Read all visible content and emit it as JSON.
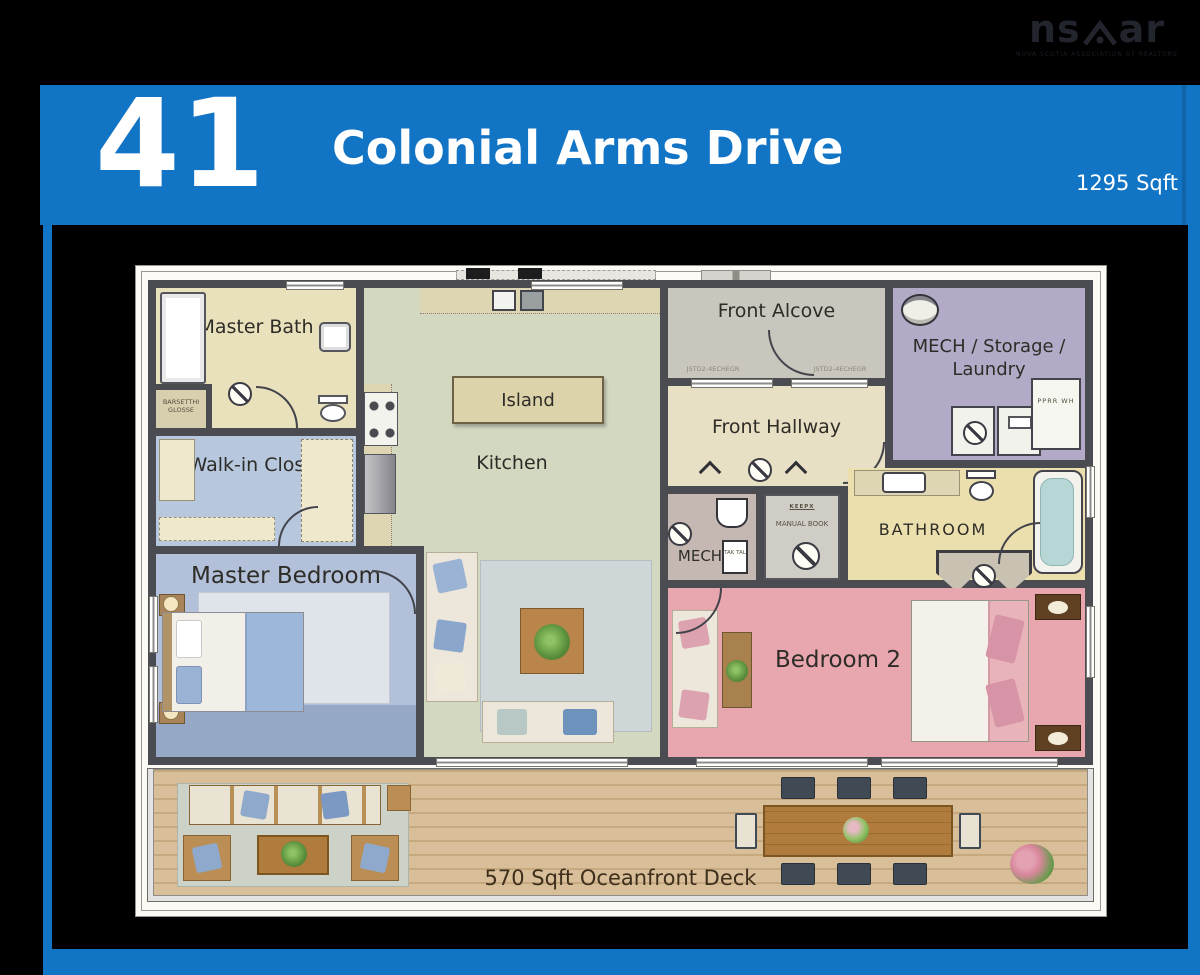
{
  "logo": {
    "left": "ns",
    "right": "ar",
    "subtext": "NOVA SCOTIA ASSOCIATION OF REALTORS"
  },
  "header": {
    "house_number": "41",
    "street": "Colonial Arms Drive",
    "area": "1295 Sqft",
    "accent_color": "#1274c5"
  },
  "rooms": {
    "master_bath": "Master Bath",
    "walk_in_closet": "Walk-in Closet",
    "master_bedroom": "Master Bedroom",
    "island": "Island",
    "kitchen": "Kitchen",
    "front_alcove": "Front Alcove",
    "front_hallway": "Front Hallway",
    "mech_storage_laundry": "MECH / Storage / Laundry",
    "mech": "MECH",
    "bathroom": "BATHROOM",
    "bedroom_2": "Bedroom 2"
  },
  "deck": {
    "label": "570 Sqft Oceanfront Deck"
  },
  "annotations": {
    "closet_tag": "BARSETTHI GLOSSE",
    "alcove_dim_left": "JSTD2-4ECHEGR",
    "alcove_dim_right": "JSTD2-4ECHEGR",
    "keep_tag": "KEEPX",
    "manual_tag": "MANUAL BOOK",
    "tak_tag": "TAK TAL",
    "wh_tag": "PPRR WH"
  },
  "palette": {
    "wall": "#4b4b52",
    "master_bath_floor": "#e9e0bc",
    "closet_floor": "#b7c7de",
    "master_bedroom_floor": "#b2c1d9",
    "kitchen_floor": "#d3d8c1",
    "alcove_floor": "#c9c6bd",
    "hallway_floor": "#e8e0c4",
    "mech_storage_floor": "#b3aac8",
    "bathroom_floor": "#ecdfae",
    "bedroom2_floor": "#e8a6ae",
    "deck_wood": "#d3b68e"
  }
}
